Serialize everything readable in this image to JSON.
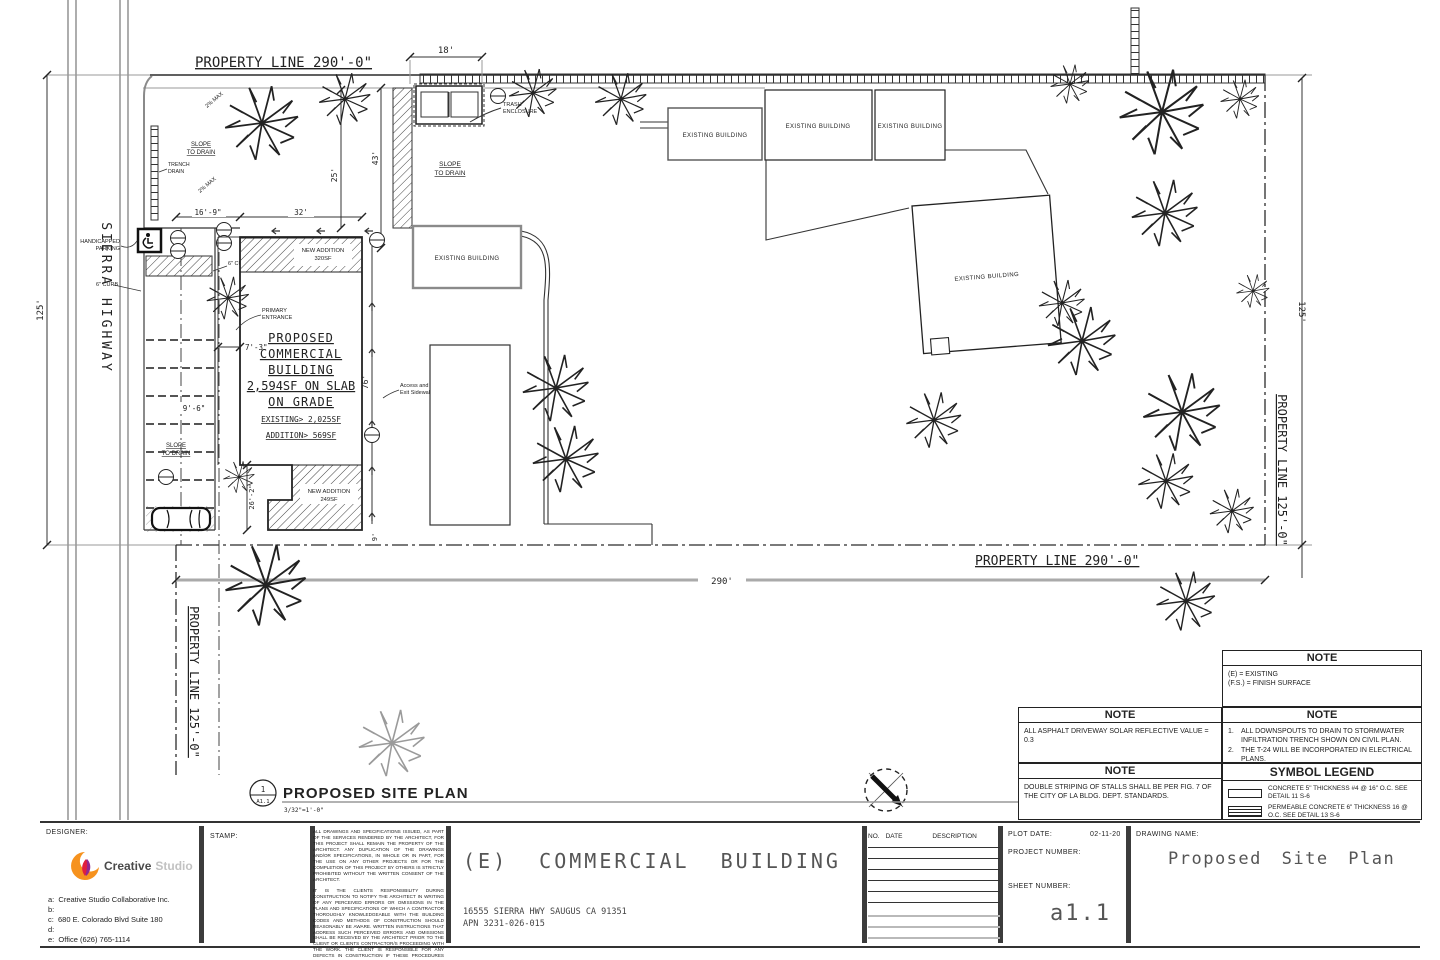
{
  "drawing": {
    "street_label": "SIERRA HIGHWAY",
    "pl": {
      "top": "PROPERTY LINE 290'-0\"",
      "bottom": "PROPERTY LINE 290'-0\"",
      "left": "PROPERTY LINE 125'-0\"",
      "right": "PROPERTY LINE 125'-0\""
    },
    "dims": {
      "left125": "125'",
      "right125": "125'",
      "d290": "290'",
      "d18": "18'",
      "d25": "25'",
      "d43": "43'",
      "d169": "16'-9\"",
      "d32": "32'",
      "d73": "7'-3\"",
      "d76": "76'",
      "d96": "9'-6\"",
      "d262": "26'-2\"",
      "d9": "9'"
    },
    "labels": {
      "handicapped1": "HANDICAPPED",
      "handicapped2": "PARKING",
      "trench1": "TRENCH",
      "trench2": "DRAIN",
      "slope1": "SLOPE",
      "slope2": "TO DRAIN",
      "pct": "2% MAX",
      "curb": "6\" CURB",
      "trash1": "TRASH",
      "trash2": "ENCLOSURE",
      "primary1": "PRIMARY",
      "primary2": "ENTRANCE",
      "access1": "Access and",
      "access2": "Exit Sidewalk",
      "existing": "EXISTING BUILDING"
    },
    "proposed": {
      "l1": "PROPOSED",
      "l2": "COMMERCIAL",
      "l3": "BUILDING",
      "l4": "2,594SF ON SLAB",
      "l5": "ON GRADE",
      "l6": "EXISTING> 2,025SF",
      "l7": "ADDITION> 569SF"
    },
    "additions": {
      "top1": "NEW ADDITION",
      "top2": "320SF",
      "bot1": "NEW ADDITION",
      "bot2": "249SF"
    }
  },
  "view_title": {
    "num": "1",
    "sheet": "A1.1",
    "title": "PROPOSED SITE PLAN",
    "scale": "3/32\"=1'-0\""
  },
  "notes": {
    "header": "NOTE",
    "abbrev": {
      "l1": "(E) = EXISTING",
      "l2": "(F.S.) = FINISH SURFACE"
    },
    "asphalt": "ALL ASPHALT DRIVEWAY SOLAR REFLECTIVE VALUE = 0.3",
    "down": {
      "n1": "1.",
      "i1": "ALL DOWNSPOUTS TO DRAIN TO STORMWATER INFILTRATION TRENCH SHOWN ON CIVIL PLAN.",
      "n2": "2.",
      "i2": "THE T-24 WILL BE INCORPORATED IN ELECTRICAL PLANS."
    },
    "striping": "DOUBLE STRIPING OF STALLS SHALL BE PER FIG. 7 OF THE CITY OF LA BLDG. DEPT. STANDARDS."
  },
  "legend": {
    "title": "SYMBOL LEGEND",
    "item1": "CONCRETE 5\" THICKNESS #4 @ 16\" O.C. SEE DETAIL 11 S-6",
    "item2": "PERMEABLE CONCRETE 6\" THICKNESS 16 @ O.C. SEE DETAIL 13 S-6"
  },
  "titleblock": {
    "designer_label": "DESIGNER:",
    "logo_word1": "Creative",
    "logo_word2": "Studio",
    "line_a": "a:  Creative Studio Collaborative Inc.",
    "line_b": "b:",
    "line_c": "c:  680 E. Colorado Blvd Suite 180",
    "line_d": "d:",
    "line_e": "e:  Office (626) 765-1114",
    "stamp_label": "STAMP:",
    "disclaimer_p1": "ALL DRAWINGS AND SPECIFICATIONS ISSUED, AS PART OF THE SERVICES RENDERED BY THE ARCHITECT, FOR THIS PROJECT SHALL REMAIN THE PROPERTY OF THE ARCHITECT. ANY DUPLICATION OF THE DRAWINGS AND/OR SPECIFICATIONS, IN WHOLE OR IN PART, FOR THE USE ON ANY OTHER PROJECTS OR FOR THE COMPLETION OF THIS PROJECT BY OTHERS IS STRICTLY PROHIBITED WITHOUT THE WRITTEN CONSENT OF THE ARCHITECT.",
    "disclaimer_p2": "IT IS THE CLIENTS RESPONSIBILITY DURING CONSTRUCTION TO NOTIFY THE ARCHITECT IN WRITING OF ANY PERCEIVED ERRORS OR OMISSIONS IN THE PLANS AND SPECIFICATIONS OF WHICH A CONTRACTOR THOROUGHLY KNOWLEDGEABLE WITH THE BUILDING CODES AND METHODS OF CONSTRUCTION SHOULD REASONABLY BE AWARE. WRITTEN INSTRUCTIONS THAT ADDRESS SUCH PERCEIVED ERRORS AND OMISSIONS SHALL BE RECEIVED BY THE ARCHITECT PRIOR TO THE CLIENT OR CLIENTS CONTRACTOR/S PROCEEDING WITH THE WORK. THE CLIENT IS RESPONSIBLE FOR ANY DEFECTS IN CONSTRUCTION IF THESE PROCEDURES ARE NOT FOLLOWED.",
    "project_title": "(E) COMMERCIAL BUILDING",
    "address": "16555 SIERRA HWY SAUGUS CA 91351",
    "apn": "APN 3231-026-015",
    "rev_no": "NO.",
    "rev_date": "DATE",
    "rev_desc": "DESCRIPTION",
    "plot_label": "PLOT DATE:",
    "plot_date": "02-11-20",
    "project_label": "PROJECT NUMBER:",
    "sheet_label": "SHEET NUMBER:",
    "sheet_number": "a1.1",
    "drawing_label": "DRAWING NAME:",
    "drawing_name": "Proposed Site Plan"
  }
}
